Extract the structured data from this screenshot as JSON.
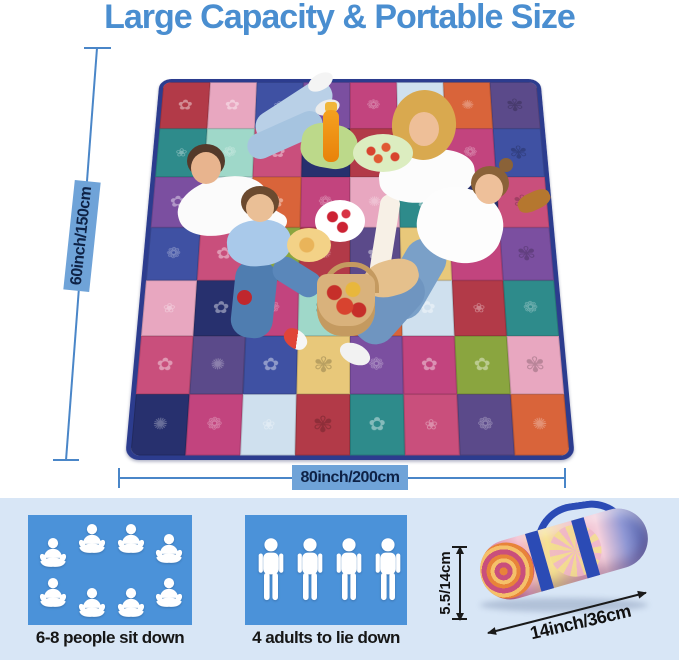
{
  "title": "Large Capacity & Portable Size",
  "colors": {
    "title_blue": "#4a8ed0",
    "dim_line_blue": "#4a86c8",
    "dim_label_bg": "#6fa3d8",
    "dim_label_text": "#0e2246",
    "panel_bg": "#d8e6f6",
    "box_blue": "#4b92d9",
    "caption_text": "#161616",
    "blanket_border": "#2c3c8e",
    "strap_blue": "#2b4bb5",
    "arrow_black": "#1a1a1a"
  },
  "blanket": {
    "width_label": "80inch/200cm",
    "height_label": "60inch/150cm",
    "patch_colors": [
      "#b23a48",
      "#e8a7c0",
      "#3f51a3",
      "#7b4fa0",
      "#c2447e",
      "#cfe0ee",
      "#d9643a",
      "#5b4a8a",
      "#2e8b8b",
      "#9fd8c9",
      "#c94f7c",
      "#27306e",
      "#b23a48",
      "#8aa53f",
      "#c2447e",
      "#3f51a3",
      "#7b4fa0",
      "#cfe0ee",
      "#d9643a",
      "#c2447e",
      "#e8a7c0",
      "#2e8b8b",
      "#27306e",
      "#c94f7c",
      "#3f51a3",
      "#c94f7c",
      "#8aa53f",
      "#b23a48",
      "#5b4a8a",
      "#e8c87a",
      "#c2447e",
      "#7b4fa0",
      "#e8a7c0",
      "#27306e",
      "#c2447e",
      "#9fd8c9",
      "#d9643a",
      "#cfe0ee",
      "#b23a48",
      "#2e8b8b",
      "#c94f7c",
      "#5b4a8a",
      "#3f51a3",
      "#e8c87a",
      "#7b4fa0",
      "#c2447e",
      "#8aa53f",
      "#e8a7c0",
      "#27306e",
      "#c2447e",
      "#cfe0ee",
      "#b23a48",
      "#2e8b8b",
      "#c94f7c",
      "#5b4a8a",
      "#d9643a"
    ]
  },
  "capacity": {
    "sit": {
      "caption": "6-8 people sit down",
      "count": 8
    },
    "lie": {
      "caption": "4 adults to lie down",
      "count": 4
    }
  },
  "roll": {
    "diameter_label": "5.5/14cm",
    "length_label": "14inch/36cm"
  },
  "icons": {
    "sit_figure": "meditating-person",
    "lie_figure": "standing-person"
  }
}
